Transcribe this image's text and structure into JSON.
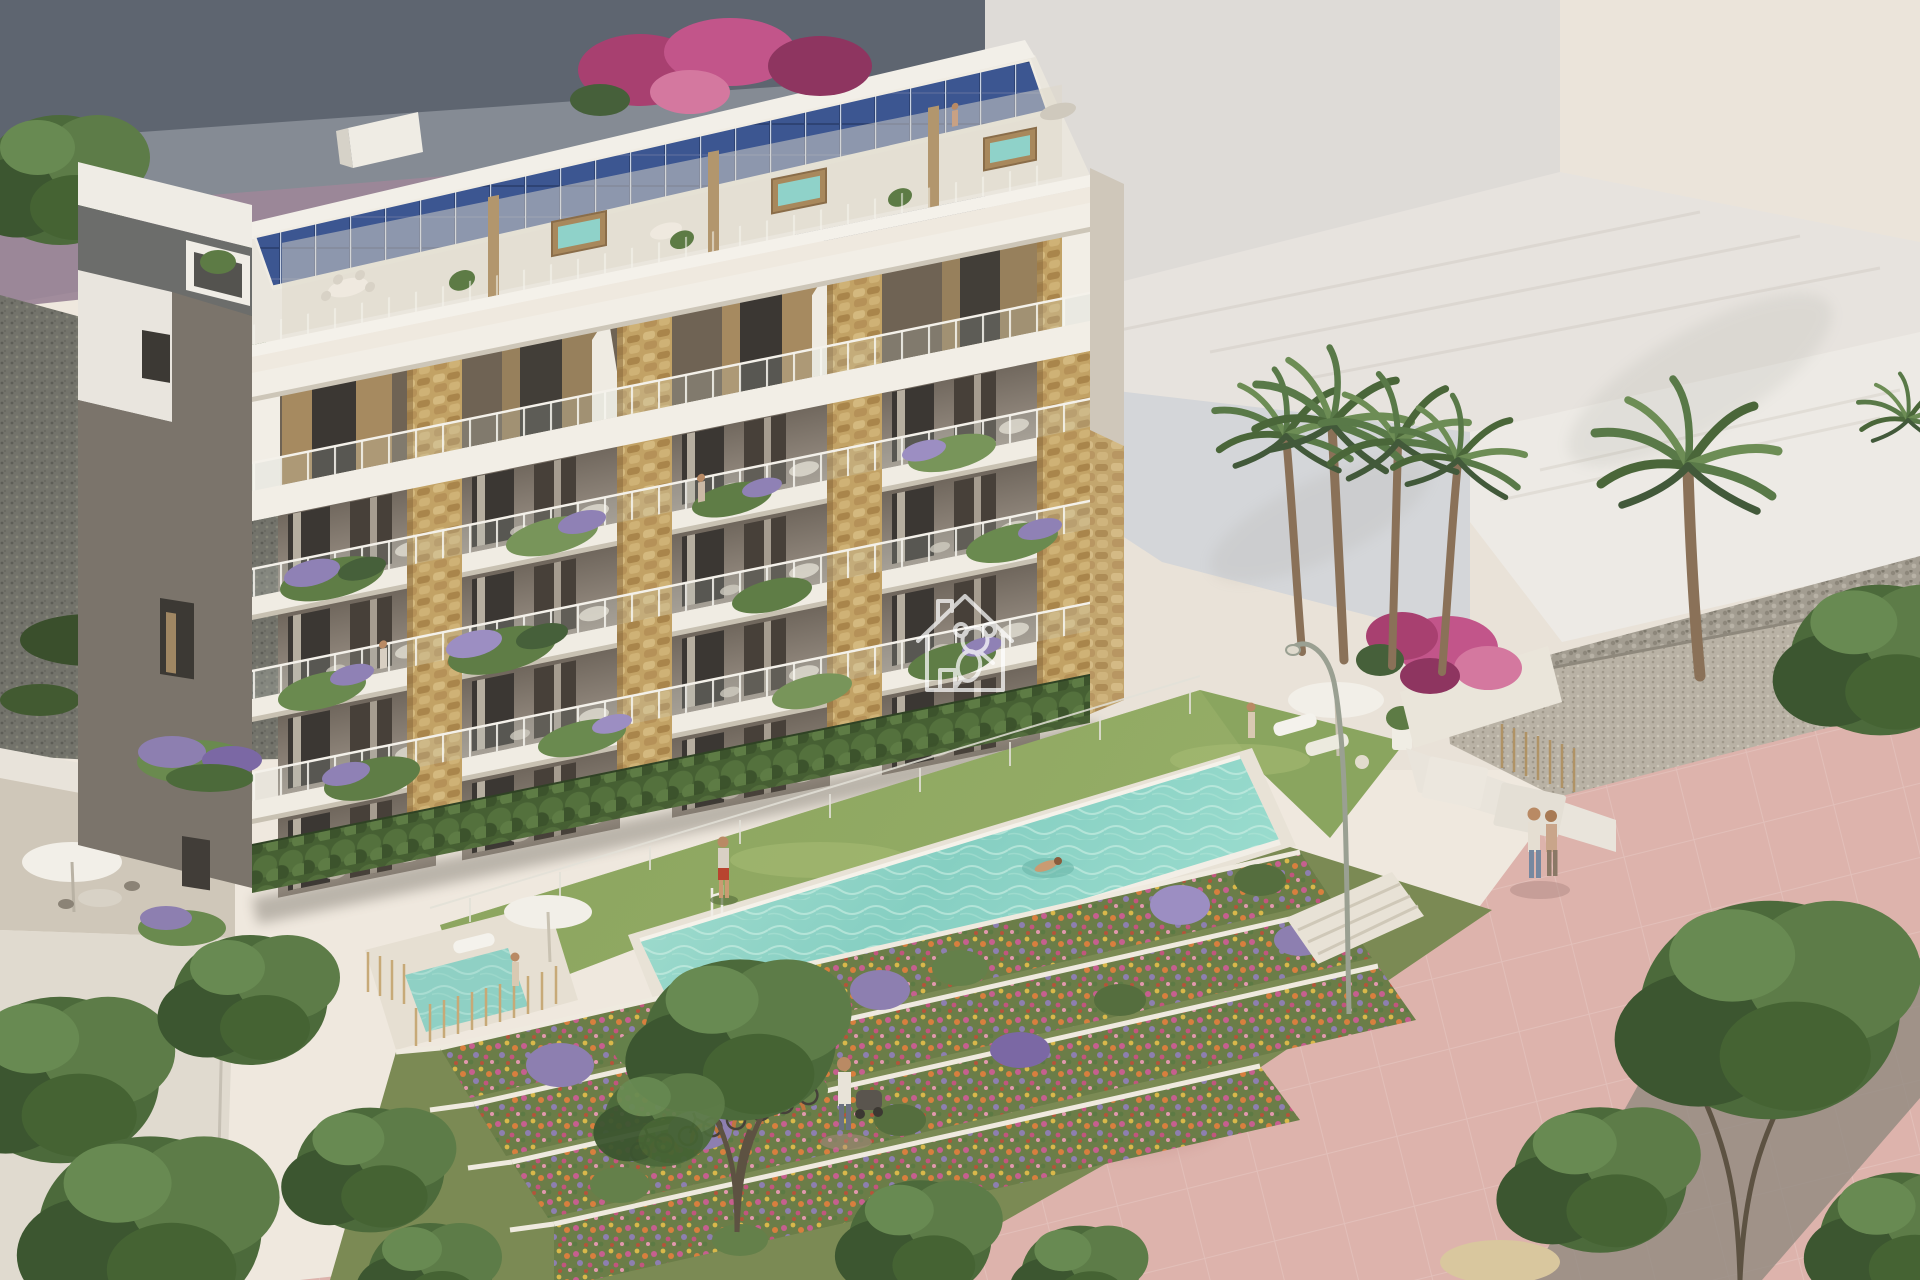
{
  "scene": {
    "type": "architectural-render",
    "subject": "aerial three-quarter view of a modern Mediterranean apartment complex with rooftop terraces, communal pool and landscaped promenade",
    "lighting": "warm late-afternoon sun from the right",
    "watermark": {
      "icon": "house-koala-logo",
      "style": "white outline",
      "color": "#ffffff",
      "opacity": 0.72
    }
  },
  "building": {
    "levels_visible": 5,
    "rooftop_features": [
      "solar-panel-array",
      "spa-hot-tubs",
      "wood-slat-partitions",
      "outdoor-dining-sets",
      "glass-balustrades"
    ],
    "facade_features": [
      "stone-clad-pillars",
      "white-concrete-frame",
      "glass-balcony-railings",
      "planted-balconies-lavender-ferns",
      "ground-floor-hedges"
    ],
    "side_wall": "grey gable with small slatted windows and flower boxes"
  },
  "amenities": {
    "infinity_pool": true,
    "sunbathing_lawn": true,
    "private_plunge_pool": true,
    "terraced_flower_gardens": true,
    "bicycle_parking": true,
    "pink_promenade": true,
    "palm_trees": true,
    "street_lamp": true,
    "parasols": 2
  },
  "people": {
    "count_visible": 9,
    "activities": [
      "swimming",
      "walking-on-promenade",
      "strolling-with-pram",
      "standing-on-lawn",
      "standing-on-balcony",
      "rooftop-relaxing"
    ]
  },
  "colors": {
    "backdrop": "#efe8de",
    "background_building_grey": "#858b94",
    "background_band_dark": "#5e6570",
    "background_band_mauve": "#9c8798",
    "pale_neighbour_walls": "#e9e2d8",
    "gable_taupe": "#7b746b",
    "roof_white": "#eae6dd",
    "solar_panel_blue": "#3b5590",
    "stone_tan": "#c2a265",
    "slab_white": "#f0ece3",
    "pool_turquoise": "#84cec1",
    "lawn_green": "#8aa55f",
    "hedge_green": "#4f6a3a",
    "flower_bed_base": "#6b7d48",
    "promenade_pink": "#ddb3ac",
    "gravel_dark": "#74746c",
    "gravel_light": "#b8b1a4",
    "tree_green": "#4c6a3b",
    "watermark_white": "#ffffff"
  }
}
